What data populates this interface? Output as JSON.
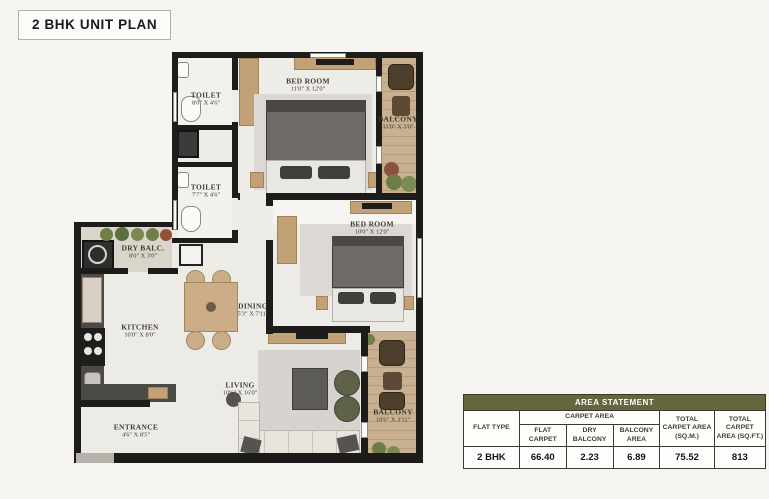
{
  "title": "2 BHK UNIT PLAN",
  "rooms": [
    {
      "id": "toilet-1",
      "name": "TOILET",
      "dims": "8'0\" X 4'6\""
    },
    {
      "id": "bedroom-1",
      "name": "BED ROOM",
      "dims": "11'0\" X 12'0\""
    },
    {
      "id": "balcony-1",
      "name": "BALCONY",
      "dims": "11'0\" X 3'0\""
    },
    {
      "id": "toilet-2",
      "name": "TOILET",
      "dims": "7'7\" X 4'6\""
    },
    {
      "id": "dry-balcony",
      "name": "DRY BALC.",
      "dims": "8'0\" X 3'0\""
    },
    {
      "id": "kitchen",
      "name": "KITCHEN",
      "dims": "10'0\" X 8'0\""
    },
    {
      "id": "dining",
      "name": "DINING",
      "dims": "5'3\" X 7'11\""
    },
    {
      "id": "bedroom-2",
      "name": "BED ROOM",
      "dims": "10'0\" X 12'0\""
    },
    {
      "id": "living",
      "name": "LIVING",
      "dims": "10'6\" X 16'0\""
    },
    {
      "id": "entrance",
      "name": "ENTRANCE",
      "dims": "4'6\" X 8'5\""
    },
    {
      "id": "balcony-2",
      "name": "BALCONY",
      "dims": "10'6\" X 3'11\""
    }
  ],
  "area_table": {
    "title": "AREA STATEMENT",
    "headers": {
      "flat_type": "FLAT TYPE",
      "carpet_area": "CARPET AREA",
      "flat_carpet": "FLAT CARPET",
      "dry_balcony": "DRY BALCONY",
      "balcony_area": "BALCONY AREA",
      "total_sqm": "TOTAL CARPET AREA (SQ.M.)",
      "total_sqft": "TOTAL CARPET AREA (SQ.FT.)"
    },
    "row": {
      "flat_type": "2 BHK",
      "flat_carpet": "66.40",
      "dry_balcony": "2.23",
      "balcony_area": "6.89",
      "total_sqm": "75.52",
      "total_sqft": "813"
    }
  },
  "colors": {
    "wall": "#1d1c1a",
    "wood_floor": "#c9b091",
    "main_floor": "#edebe6",
    "table_header_bg": "#65653e",
    "table_header_text": "#ffffff",
    "furniture_tan": "#c3a177",
    "plant_green": "#6f7f48"
  }
}
